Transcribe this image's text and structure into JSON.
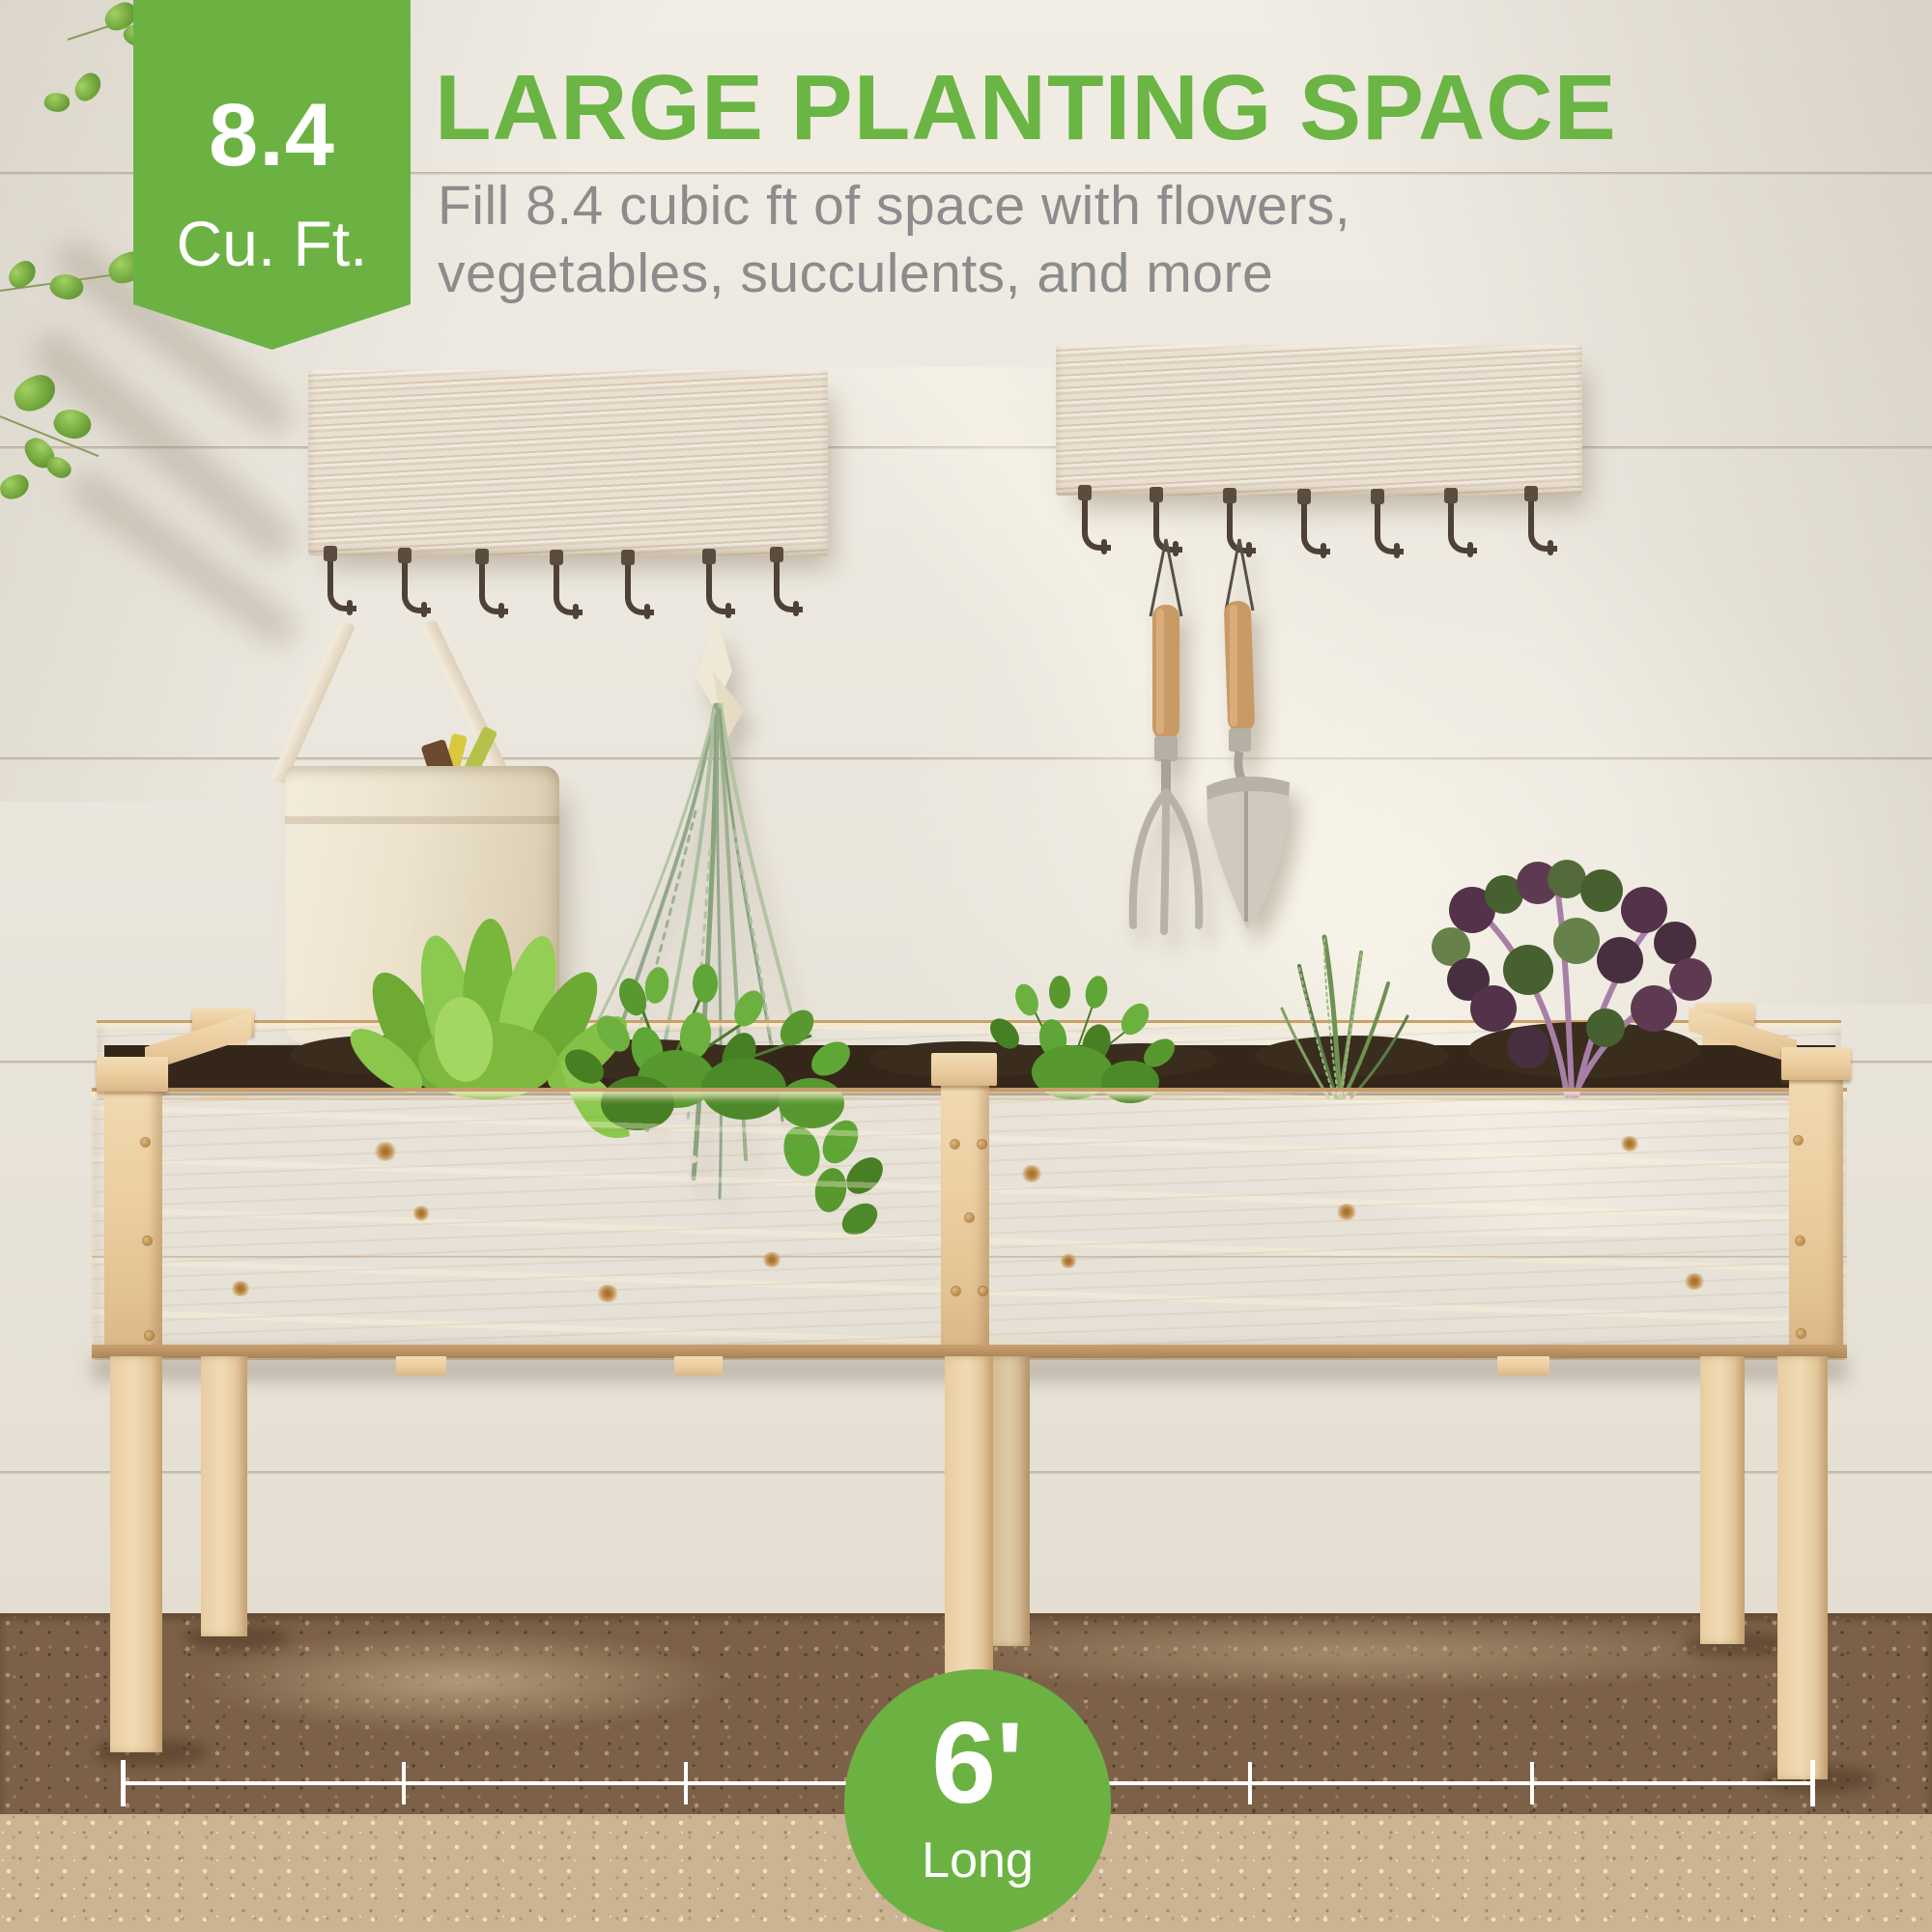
{
  "badge": {
    "value": "8.4",
    "unit": "Cu. Ft."
  },
  "headline": "LARGE PLANTING SPACE",
  "subtitle": {
    "line1": "Fill 8.4 cubic ft of space with flowers,",
    "line2": "vegetables, succulents, and more"
  },
  "dimension": {
    "value": "6'",
    "label": "Long"
  },
  "colors": {
    "brand_green": "#6cb243",
    "headline_green": "#6ab544",
    "subtitle_gray": "#8c8c8c",
    "dimension_white": "#ffffff",
    "planter_wood": "#eccfa2",
    "wall_white": "#ebe7de",
    "gravel_dark": "#7c6148",
    "gravel_light": "#ccb493",
    "soil_brown": "#34271a"
  }
}
